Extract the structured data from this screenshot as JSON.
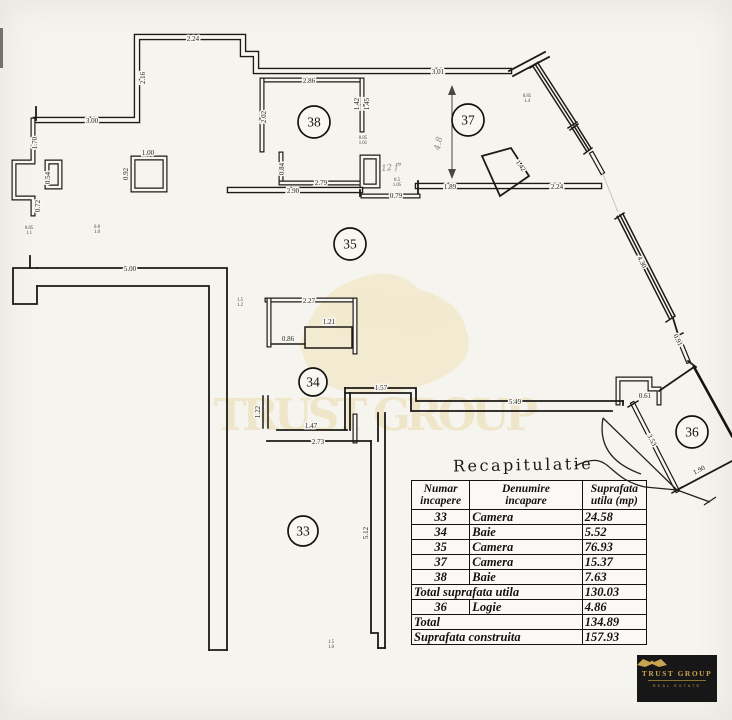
{
  "colors": {
    "paper": "#f8f6f1",
    "ink": "#1c1a16",
    "watermark": "#eee3c2",
    "logo_bg": "#171717",
    "logo_gold": "#c9a350"
  },
  "plan": {
    "watermark_text": "TRUST GROUP",
    "rooms": [
      {
        "label": "33",
        "x": 303,
        "y": 531,
        "r": 15
      },
      {
        "label": "34",
        "x": 313,
        "y": 382,
        "r": 14
      },
      {
        "label": "35",
        "x": 350,
        "y": 244,
        "r": 16
      },
      {
        "label": "36",
        "x": 692,
        "y": 432,
        "r": 16
      },
      {
        "label": "37",
        "x": 468,
        "y": 120,
        "r": 16
      },
      {
        "label": "38",
        "x": 314,
        "y": 122,
        "r": 16
      }
    ],
    "dimensions": [
      {
        "text": "2.24",
        "x": 193,
        "y": 41,
        "r": 0
      },
      {
        "text": "2.16",
        "x": 145,
        "y": 78,
        "r": -90
      },
      {
        "text": "3.00",
        "x": 92,
        "y": 123,
        "r": 0
      },
      {
        "text": "1.70",
        "x": 37,
        "y": 143,
        "r": -90
      },
      {
        "text": "0.54",
        "x": 50,
        "y": 178,
        "r": -90
      },
      {
        "text": "0.72",
        "x": 40,
        "y": 206,
        "r": -90
      },
      {
        "text": "1.00",
        "x": 148,
        "y": 155,
        "r": 0
      },
      {
        "text": "0.92",
        "x": 128,
        "y": 174,
        "r": -90
      },
      {
        "text": "2.86",
        "x": 309,
        "y": 83,
        "r": 0
      },
      {
        "text": "2.02",
        "x": 266,
        "y": 117,
        "r": -90
      },
      {
        "text": "1.42",
        "x": 359,
        "y": 104,
        "r": -90
      },
      {
        "text": "1.45",
        "x": 369,
        "y": 104,
        "r": -90
      },
      {
        "text": "0.84",
        "x": 284,
        "y": 169,
        "r": -90
      },
      {
        "text": "2.79",
        "x": 321,
        "y": 185,
        "r": 0
      },
      {
        "text": "2.90",
        "x": 293,
        "y": 193,
        "r": 0
      },
      {
        "text": "0.79",
        "x": 396,
        "y": 198,
        "r": 0
      },
      {
        "text": "3.01",
        "x": 438,
        "y": 74,
        "r": 0
      },
      {
        "text": "1.89",
        "x": 450,
        "y": 189,
        "r": 0
      },
      {
        "text": "2.24",
        "x": 557,
        "y": 189,
        "r": 0
      },
      {
        "text": "1.42",
        "x": 519,
        "y": 167,
        "r": 55
      },
      {
        "text": "5.00",
        "x": 130,
        "y": 271,
        "r": 0
      },
      {
        "text": "2.27",
        "x": 309,
        "y": 303,
        "r": 0
      },
      {
        "text": "1.21",
        "x": 329,
        "y": 324,
        "r": 0
      },
      {
        "text": "0.86",
        "x": 288,
        "y": 341,
        "r": 0
      },
      {
        "text": "1.22",
        "x": 260,
        "y": 412,
        "r": -90
      },
      {
        "text": "1.47",
        "x": 311,
        "y": 428,
        "r": 0
      },
      {
        "text": "2.73",
        "x": 318,
        "y": 444,
        "r": 0
      },
      {
        "text": "1.57",
        "x": 381,
        "y": 390,
        "r": 0
      },
      {
        "text": "5.49",
        "x": 515,
        "y": 404,
        "r": 0
      },
      {
        "text": "5.12",
        "x": 368,
        "y": 533,
        "r": -90
      },
      {
        "text": "4.30",
        "x": 640,
        "y": 263,
        "r": 63
      },
      {
        "text": "0.91",
        "x": 676,
        "y": 341,
        "r": 63
      },
      {
        "text": "0.61",
        "x": 645,
        "y": 398,
        "r": 0
      },
      {
        "text": "3.53",
        "x": 650,
        "y": 441,
        "r": 63
      },
      {
        "text": "1.90",
        "x": 700,
        "y": 472,
        "r": -27
      }
    ],
    "micro_marks": [
      {
        "x": 363,
        "y": 139,
        "l1": "0.85",
        "l2": "1.01"
      },
      {
        "x": 397,
        "y": 181,
        "l1": "0.5",
        "l2": "1.05"
      },
      {
        "x": 240,
        "y": 301,
        "l1": "1.5",
        "l2": "1.2"
      },
      {
        "x": 331,
        "y": 643,
        "l1": "1.5",
        "l2": "1.0"
      },
      {
        "x": 29,
        "y": 229,
        "l1": "0.85",
        "l2": "1.1"
      },
      {
        "x": 97,
        "y": 228,
        "l1": "0.8",
        "l2": "1.0"
      },
      {
        "x": 527,
        "y": 97,
        "l1": "0.85",
        "l2": "1.4"
      }
    ],
    "pencil_notes": [
      {
        "text": "12 f°",
        "x": 392,
        "y": 170,
        "r": -6
      },
      {
        "text": "4.8",
        "x": 441,
        "y": 144,
        "r": -78
      }
    ]
  },
  "table": {
    "title": "Recapitulatie",
    "columns": [
      "Numar\nincapere",
      "Denumire\nincapare",
      "Suprafata\nutila (mp)"
    ],
    "rows": [
      {
        "num": "33",
        "name": "Camera",
        "area": "24.58"
      },
      {
        "num": "34",
        "name": "Baie",
        "area": "5.52"
      },
      {
        "num": "35",
        "name": "Camera",
        "area": "76.93"
      },
      {
        "num": "37",
        "name": "Camera",
        "area": "15.37"
      },
      {
        "num": "38",
        "name": "Baie",
        "area": "7.63"
      }
    ],
    "total_utila": {
      "label": "Total suprafata utila",
      "value": "130.03"
    },
    "logie": {
      "num": "36",
      "name": "Logie",
      "area": "4.86"
    },
    "total": {
      "label": "Total",
      "value": "134.89"
    },
    "construita": {
      "label": "Suprafata construita",
      "value": "157.93"
    }
  },
  "logo": {
    "brand": "TRUST GROUP",
    "tagline": "REAL ESTATE"
  }
}
